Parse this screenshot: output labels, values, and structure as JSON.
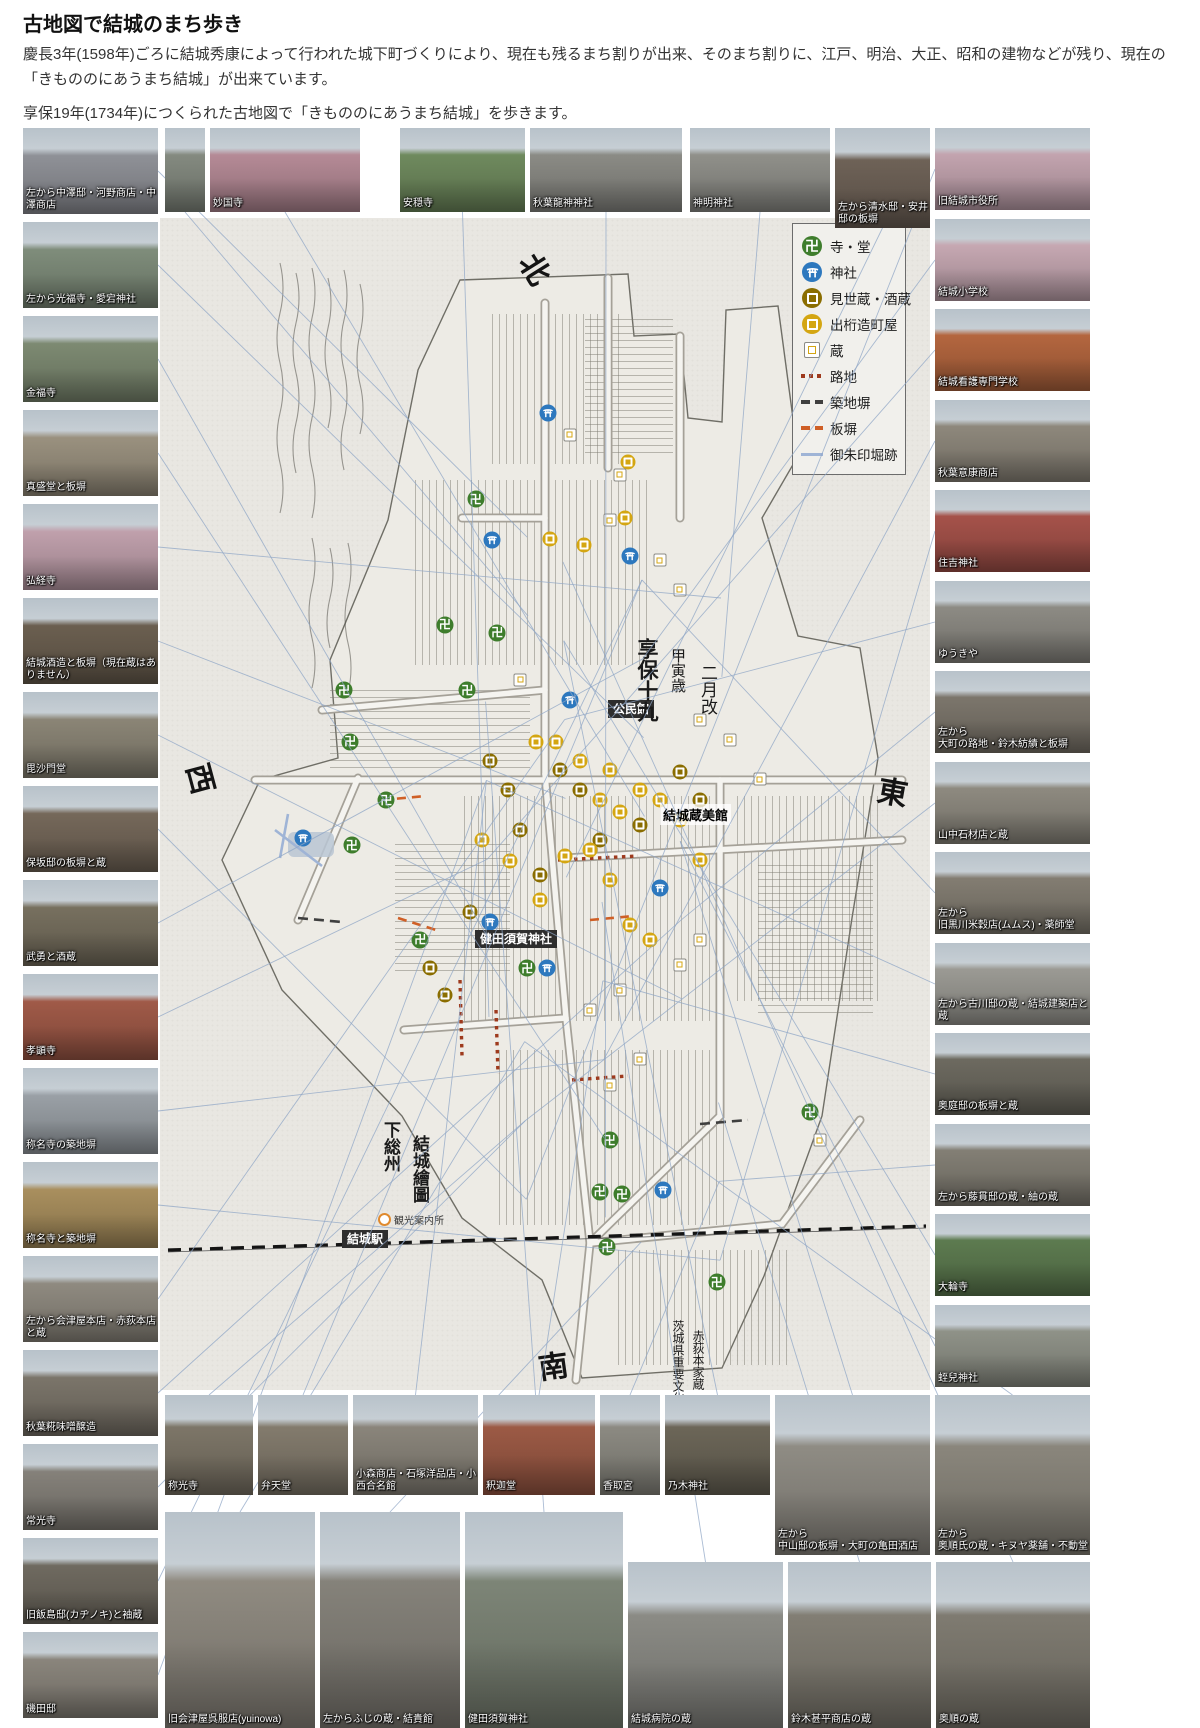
{
  "header": {
    "title": "古地図で結城のまち歩き",
    "para1": "慶長3年(1598年)ごろに結城秀康によって行われた城下町づくりにより、現在も残るまち割りが出来、そのまち割りに、江戸、明治、大正、昭和の建物などが残り、現在の「きもののにあうまち結城」が出来ています。",
    "para2": "享保19年(1734年)につくられた古地図で「きもののにあうまち結城」を歩きます。"
  },
  "colors": {
    "temple": "#3e7d2c",
    "shrine": "#2d78be",
    "misegura": "#8a6d00",
    "degeta": "#d4a612",
    "roji": "#9e3a1d",
    "tsuijibei": "#3f3f3f",
    "itabei": "#cf5f26",
    "goshuin": "#9fb4d6"
  },
  "legend": {
    "items": [
      {
        "icon": "temple-icon",
        "label": "寺・堂"
      },
      {
        "icon": "shrine-icon",
        "label": "神社"
      },
      {
        "icon": "misegura-icon",
        "label": "見世蔵・酒蔵"
      },
      {
        "icon": "degeta-icon",
        "label": "出桁造町屋"
      },
      {
        "icon": "kura-icon",
        "label": "蔵"
      },
      {
        "icon": "roji-line",
        "label": "路地"
      },
      {
        "icon": "tsuijibei-line",
        "label": "築地塀"
      },
      {
        "icon": "itabei-line",
        "label": "板塀"
      },
      {
        "icon": "goshuin-line",
        "label": "御朱印堀跡"
      }
    ]
  },
  "map_labels": {
    "kominkan": "公民館",
    "kurabikan": "結城蔵美館",
    "kendasuga": "健田須賀神社",
    "station": "結城駅",
    "info": "観光案内所",
    "era1": "享保十九",
    "era2": "甲寅歳",
    "era3": "二月改",
    "map_name1": "下総州",
    "map_name2": "結城繪圖",
    "cultural1": "茨城県重要文化財",
    "cultural2": "赤荻本家蔵",
    "north": "北",
    "south": "南",
    "east": "東",
    "west": "西"
  },
  "photos": {
    "top": [
      {
        "caption": ""
      },
      {
        "caption": "妙国寺",
        "tint": "#b58a96"
      },
      {
        "caption": "安穏寺",
        "tint": "#6f8a5e"
      },
      {
        "caption": "秋葉龍神神社",
        "tint": "#8b8b85"
      },
      {
        "caption": "神明神社",
        "tint": "#90908a"
      },
      {
        "caption": "左から清水邸・安井邸の板塀",
        "tint": "#6e6257"
      }
    ],
    "left": [
      {
        "caption": "左から中澤邸・河野商店・中澤商店",
        "tint": "#8f9197"
      },
      {
        "caption": "左から光福寺・愛宕神社",
        "tint": "#7f8d7b"
      },
      {
        "caption": "金福寺",
        "tint": "#7d8a72"
      },
      {
        "caption": "真盛堂と板塀",
        "tint": "#9a917f"
      },
      {
        "caption": "弘経寺",
        "tint": "#c0a0ac"
      },
      {
        "caption": "結城酒造と板塀（現在蔵はありません）",
        "tint": "#6b5f50"
      },
      {
        "caption": "毘沙門堂",
        "tint": "#8b8576"
      },
      {
        "caption": "保坂邸の板塀と蔵",
        "tint": "#75685a"
      },
      {
        "caption": "武勇と酒蔵",
        "tint": "#77705f"
      },
      {
        "caption": "孝顕寺",
        "tint": "#a05a48"
      },
      {
        "caption": "称名寺の築地塀",
        "tint": "#9aa0a6"
      },
      {
        "caption": "称名寺と築地塀",
        "tint": "#a98f5e"
      },
      {
        "caption": "左から会津屋本店・赤荻本店と蔵",
        "tint": "#8f8a80"
      },
      {
        "caption": "秋葉糀味噌醸造",
        "tint": "#7b756a"
      },
      {
        "caption": "常光寺",
        "tint": "#85817a"
      },
      {
        "caption": "旧飯島邸(カヂノキ)と袖蔵",
        "tint": "#6f6a60"
      },
      {
        "caption": "磯田邸",
        "tint": "#8a857c"
      }
    ],
    "right": [
      {
        "caption": "旧結城市役所",
        "tint": "#c3a4af"
      },
      {
        "caption": "結城小学校",
        "tint": "#c6a8b2"
      },
      {
        "caption": "結城看護専門学校",
        "tint": "#b4663f"
      },
      {
        "caption": "秋葉意康商店",
        "tint": "#8e887c"
      },
      {
        "caption": "住吉神社",
        "tint": "#a5524a"
      },
      {
        "caption": "ゆうきや",
        "tint": "#8d8b84"
      },
      {
        "caption": "左から\n大町の路地・鈴木紡績と板塀",
        "tint": "#7c766c"
      },
      {
        "caption": "山中石材店と蔵",
        "tint": "#8e8a80"
      },
      {
        "caption": "左から\n旧黒川米穀店(ムムス)・薬師堂",
        "tint": "#837d72"
      },
      {
        "caption": "左から古川邸の蔵・結城建築店と蔵",
        "tint": "#9b9a94"
      },
      {
        "caption": "奥庭邸の板塀と蔵",
        "tint": "#6d6a60"
      },
      {
        "caption": "左から藤貫邸の蔵・紬の蔵",
        "tint": "#837f75"
      },
      {
        "caption": "大輪寺",
        "tint": "#5d7b50"
      },
      {
        "caption": "蛭兒神社",
        "tint": "#8f9288"
      }
    ],
    "bottomA": [
      {
        "caption": "称光寺",
        "tint": "#7d7668"
      },
      {
        "caption": "弁天堂",
        "tint": "#837b6d"
      },
      {
        "caption": "小森商店・石塚洋品店・小西合名館",
        "tint": "#8a857b"
      },
      {
        "caption": "釈迦堂",
        "tint": "#9c5a45"
      },
      {
        "caption": "香取宮",
        "tint": "#8c8a82"
      },
      {
        "caption": "乃木神社",
        "tint": "#6c6658"
      },
      {
        "caption": "左から\n中山邸の板塀・大町の亀田酒店",
        "tint": "#8f8c84"
      },
      {
        "caption": "左から\n奥順氏の蔵・キヌヤ薬舗・不動堂",
        "tint": "#8a867c"
      }
    ],
    "bottomB": [
      {
        "caption": "旧会津屋呉服店(yuinowa)",
        "tint": "#908b81"
      },
      {
        "caption": "左からふじの蔵・結貴館",
        "tint": "#85827a"
      },
      {
        "caption": "健田須賀神社",
        "tint": "#7d8577"
      },
      {
        "caption": "結城病院の蔵",
        "tint": "#8b8b85"
      },
      {
        "caption": "鈴木甚平商店の蔵",
        "tint": "#827e74"
      },
      {
        "caption": "奥順の蔵",
        "tint": "#7f7b71"
      }
    ]
  },
  "markers": [
    {
      "t": "temple",
      "x": 41,
      "y": 24
    },
    {
      "t": "temple",
      "x": 37,
      "y": 34.7
    },
    {
      "t": "temple",
      "x": 43.8,
      "y": 35.4
    },
    {
      "t": "temple",
      "x": 23.9,
      "y": 40.3
    },
    {
      "t": "temple",
      "x": 39.9,
      "y": 40.3
    },
    {
      "t": "temple",
      "x": 24.7,
      "y": 44.7
    },
    {
      "t": "temple",
      "x": 29.4,
      "y": 49.7
    },
    {
      "t": "temple",
      "x": 24.9,
      "y": 53.5
    },
    {
      "t": "temple",
      "x": 33.8,
      "y": 61.6
    },
    {
      "t": "temple",
      "x": 47.7,
      "y": 64
    },
    {
      "t": "temple",
      "x": 58.4,
      "y": 78.7
    },
    {
      "t": "temple",
      "x": 57.1,
      "y": 83.1
    },
    {
      "t": "temple",
      "x": 60,
      "y": 83.3
    },
    {
      "t": "temple",
      "x": 58.1,
      "y": 87.8
    },
    {
      "t": "temple",
      "x": 72.3,
      "y": 90.8
    },
    {
      "t": "temple",
      "x": 84.4,
      "y": 76.3
    },
    {
      "t": "shrine",
      "x": 50.4,
      "y": 16.6
    },
    {
      "t": "shrine",
      "x": 61,
      "y": 28.8
    },
    {
      "t": "shrine",
      "x": 53.2,
      "y": 41.1
    },
    {
      "t": "shrine",
      "x": 43.1,
      "y": 27.5
    },
    {
      "t": "shrine",
      "x": 18.6,
      "y": 52.9
    },
    {
      "t": "shrine",
      "x": 42.9,
      "y": 60.1
    },
    {
      "t": "shrine",
      "x": 64.9,
      "y": 57.2
    },
    {
      "t": "shrine",
      "x": 50.3,
      "y": 64
    },
    {
      "t": "shrine",
      "x": 65.3,
      "y": 82.9
    },
    {
      "t": "misegura",
      "x": 42.9,
      "y": 46.3
    },
    {
      "t": "misegura",
      "x": 45.2,
      "y": 48.8
    },
    {
      "t": "misegura",
      "x": 46.8,
      "y": 52.2
    },
    {
      "t": "misegura",
      "x": 51.9,
      "y": 47.1
    },
    {
      "t": "misegura",
      "x": 54.5,
      "y": 48.8
    },
    {
      "t": "misegura",
      "x": 57.1,
      "y": 53.1
    },
    {
      "t": "misegura",
      "x": 67.5,
      "y": 47.3
    },
    {
      "t": "misegura",
      "x": 70.1,
      "y": 49.7
    },
    {
      "t": "misegura",
      "x": 62.3,
      "y": 51.8
    },
    {
      "t": "misegura",
      "x": 49.4,
      "y": 56.1
    },
    {
      "t": "misegura",
      "x": 40.3,
      "y": 59.2
    },
    {
      "t": "misegura",
      "x": 35.1,
      "y": 64
    },
    {
      "t": "misegura",
      "x": 37,
      "y": 66.3
    },
    {
      "t": "degeta",
      "x": 48.8,
      "y": 44.7
    },
    {
      "t": "degeta",
      "x": 51.4,
      "y": 44.7
    },
    {
      "t": "degeta",
      "x": 54.5,
      "y": 46.3
    },
    {
      "t": "degeta",
      "x": 58.4,
      "y": 47.1
    },
    {
      "t": "degeta",
      "x": 57.1,
      "y": 49.7
    },
    {
      "t": "degeta",
      "x": 59.7,
      "y": 50.7
    },
    {
      "t": "degeta",
      "x": 62.3,
      "y": 48.8
    },
    {
      "t": "degeta",
      "x": 64.9,
      "y": 49.7
    },
    {
      "t": "degeta",
      "x": 67.5,
      "y": 51.4
    },
    {
      "t": "degeta",
      "x": 70.1,
      "y": 54.8
    },
    {
      "t": "degeta",
      "x": 55.8,
      "y": 53.9
    },
    {
      "t": "degeta",
      "x": 52.6,
      "y": 54.4
    },
    {
      "t": "degeta",
      "x": 58.4,
      "y": 56.5
    },
    {
      "t": "degeta",
      "x": 61,
      "y": 60.3
    },
    {
      "t": "degeta",
      "x": 63.6,
      "y": 61.6
    },
    {
      "t": "degeta",
      "x": 49.4,
      "y": 58.2
    },
    {
      "t": "degeta",
      "x": 45.5,
      "y": 54.9
    },
    {
      "t": "degeta",
      "x": 41.8,
      "y": 53.1
    },
    {
      "t": "degeta",
      "x": 60.8,
      "y": 20.8
    },
    {
      "t": "degeta",
      "x": 55,
      "y": 27.9
    },
    {
      "t": "degeta",
      "x": 50.6,
      "y": 27.4
    },
    {
      "t": "degeta",
      "x": 60.4,
      "y": 25.6
    },
    {
      "t": "kura",
      "x": 53.2,
      "y": 18.5
    },
    {
      "t": "kura",
      "x": 59.7,
      "y": 21.9
    },
    {
      "t": "kura",
      "x": 58.4,
      "y": 25.8
    },
    {
      "t": "kura",
      "x": 64.9,
      "y": 29.2
    },
    {
      "t": "kura",
      "x": 67.5,
      "y": 31.7
    },
    {
      "t": "kura",
      "x": 46.8,
      "y": 39.4
    },
    {
      "t": "kura",
      "x": 70.1,
      "y": 42.8
    },
    {
      "t": "kura",
      "x": 74,
      "y": 44.5
    },
    {
      "t": "kura",
      "x": 77.9,
      "y": 47.9
    },
    {
      "t": "kura",
      "x": 70.1,
      "y": 61.6
    },
    {
      "t": "kura",
      "x": 67.5,
      "y": 63.7
    },
    {
      "t": "kura",
      "x": 59.7,
      "y": 65.9
    },
    {
      "t": "kura",
      "x": 55.8,
      "y": 67.6
    },
    {
      "t": "kura",
      "x": 62.3,
      "y": 71.8
    },
    {
      "t": "kura",
      "x": 58.4,
      "y": 74
    },
    {
      "t": "kura",
      "x": 85.7,
      "y": 78.7
    }
  ]
}
